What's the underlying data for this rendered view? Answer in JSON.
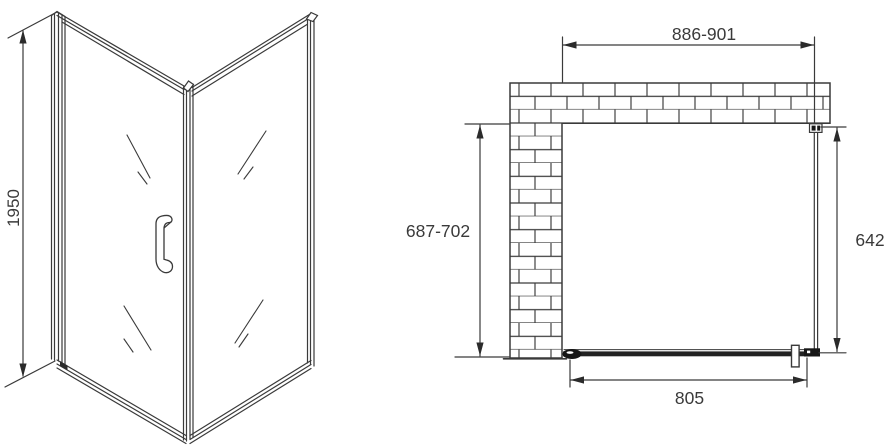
{
  "drawing": {
    "isometric_view": {
      "height_label": "1950"
    },
    "plan_view": {
      "opening_width_label": "886-901",
      "wall_depth_label": "687-702",
      "side_panel_label": "642",
      "door_width_label": "805"
    },
    "colors": {
      "line": "#3a3a3a",
      "dark_fill": "#161616",
      "background": "#ffffff"
    }
  }
}
